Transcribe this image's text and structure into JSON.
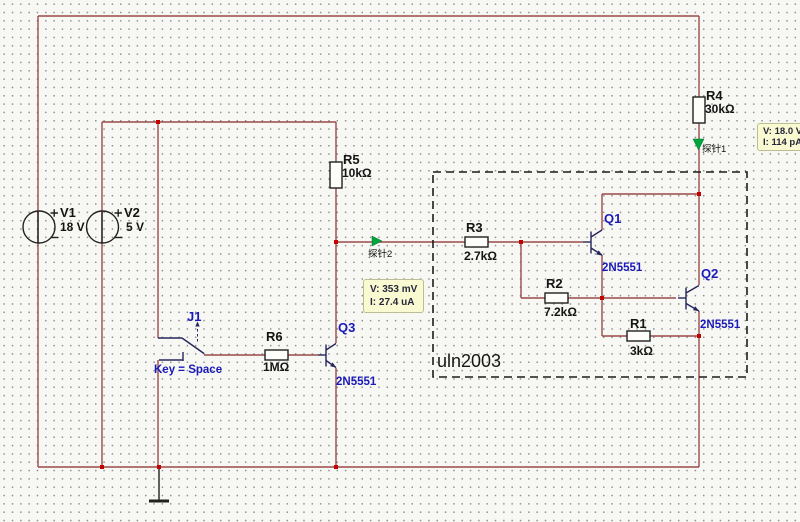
{
  "sources": {
    "v1": {
      "ref": "V1",
      "value": "18 V"
    },
    "v2": {
      "ref": "V2",
      "value": "5 V"
    }
  },
  "resistors": {
    "r1": {
      "ref": "R1",
      "value": "3kΩ"
    },
    "r2": {
      "ref": "R2",
      "value": "7.2kΩ"
    },
    "r3": {
      "ref": "R3",
      "value": "2.7kΩ"
    },
    "r4": {
      "ref": "R4",
      "value": "30kΩ"
    },
    "r5": {
      "ref": "R5",
      "value": "10kΩ"
    },
    "r6": {
      "ref": "R6",
      "value": "1MΩ"
    }
  },
  "transistors": {
    "q1": {
      "ref": "Q1",
      "part": "2N5551"
    },
    "q2": {
      "ref": "Q2",
      "part": "2N5551"
    },
    "q3": {
      "ref": "Q3",
      "part": "2N5551"
    }
  },
  "switch_j1": {
    "ref": "J1",
    "key_label": "Key = Space"
  },
  "annotation": {
    "ic_label": "uln2003"
  },
  "probes": {
    "p1": {
      "label": "探针1",
      "voltage": "V: 18.0 V",
      "current": "I: 114 pA"
    },
    "p2": {
      "label": "探针2",
      "voltage": "V: 353 mV",
      "current": "I: 27.4 uA"
    }
  },
  "colors": {
    "canvas_bg": "#f7f7f3",
    "grid_dot": "#8e8e8e",
    "wire": "#9a4a4a",
    "symbol": "#26265c",
    "component": "#202020",
    "junction": "#c40000",
    "probe_green": "#00a33c",
    "label_blue": "#1a1ab8",
    "tooltip_bg": "#fafad2",
    "tooltip_border": "#bdbd92"
  }
}
